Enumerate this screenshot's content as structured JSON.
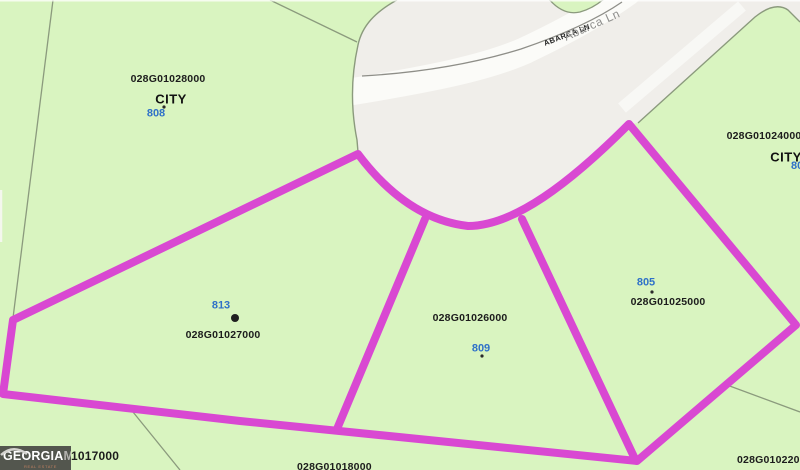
{
  "map": {
    "road": {
      "name_caps": "ABARCA LN",
      "name_mixed": "Abarca Ln"
    },
    "labels": {
      "top_left": {
        "parcel_id": "028G01028000",
        "zone": "CITY",
        "lot": "808"
      },
      "top_right": {
        "parcel_id": "028G01024000",
        "zone": "CITY",
        "lot": "806"
      },
      "lot_813": {
        "lot": "813",
        "parcel_id": "028G01027000"
      },
      "lot_809": {
        "parcel_id": "028G01026000",
        "lot": "809"
      },
      "lot_805": {
        "lot": "805",
        "parcel_id": "028G01025000"
      },
      "bottom_left": {
        "parcel_id_visible": "1017000"
      },
      "bottom_center": {
        "parcel_id": "028G01018000"
      },
      "bottom_right": {
        "parcel_id": "028G01022000"
      }
    },
    "watermark": {
      "brand_primary": "GEORGIA",
      "brand_secondary": "MLS",
      "tagline": "REAL ESTATE SERVICES"
    },
    "colors": {
      "parcel_green": "#d9f4c0",
      "road_gray": "#f0eeea",
      "road_white": "#fbfbf8",
      "highlight_magenta": "#d948d2",
      "boundary_green": "#8b9a7d",
      "centerline_gray": "#8e8e88",
      "lot_number_blue": "#2f71c8",
      "label_black": "#1c1c1c"
    }
  }
}
